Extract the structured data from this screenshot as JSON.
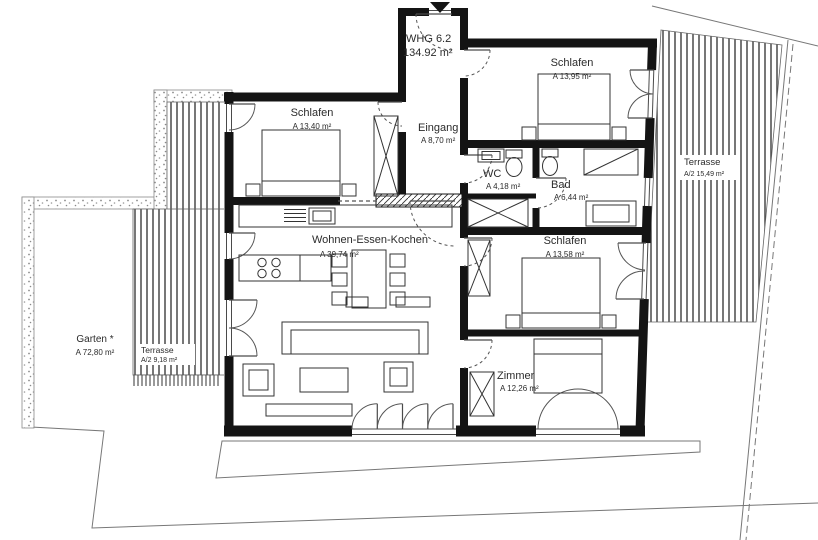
{
  "plan": {
    "title": {
      "name": "WHG 6.2",
      "area": "134.92 m²"
    },
    "rooms": {
      "schlafen1": {
        "name": "Schlafen",
        "area": "A  13,40 m²"
      },
      "schlafen2": {
        "name": "Schlafen",
        "area": "A  13,95 m²"
      },
      "eingang": {
        "name": "Eingang",
        "area": "A  8,70 m²"
      },
      "wc": {
        "name": "WC",
        "area": "A  4,18 m²"
      },
      "bad": {
        "name": "Bad",
        "area": "A  6,44 m²"
      },
      "schlafen3": {
        "name": "Schlafen",
        "area": "A  13,58 m²"
      },
      "wohnen": {
        "name": "Wohnen-Essen-Kochen",
        "area": "A  39,74 m²"
      },
      "zimmer": {
        "name": "Zimmer",
        "area": "A  12,26 m²"
      }
    },
    "outdoor": {
      "garten": {
        "name": "Garten *",
        "area": "A  72,80 m²"
      },
      "terrasse_w": {
        "name": "Terrasse",
        "area": "A/2  9,18 m²"
      },
      "terrasse_e": {
        "name": "Terrasse",
        "area": "A/2  15,49 m²"
      }
    },
    "colors": {
      "wall": "#141414",
      "thin": "#4a4a4a",
      "site": "#777777"
    }
  }
}
